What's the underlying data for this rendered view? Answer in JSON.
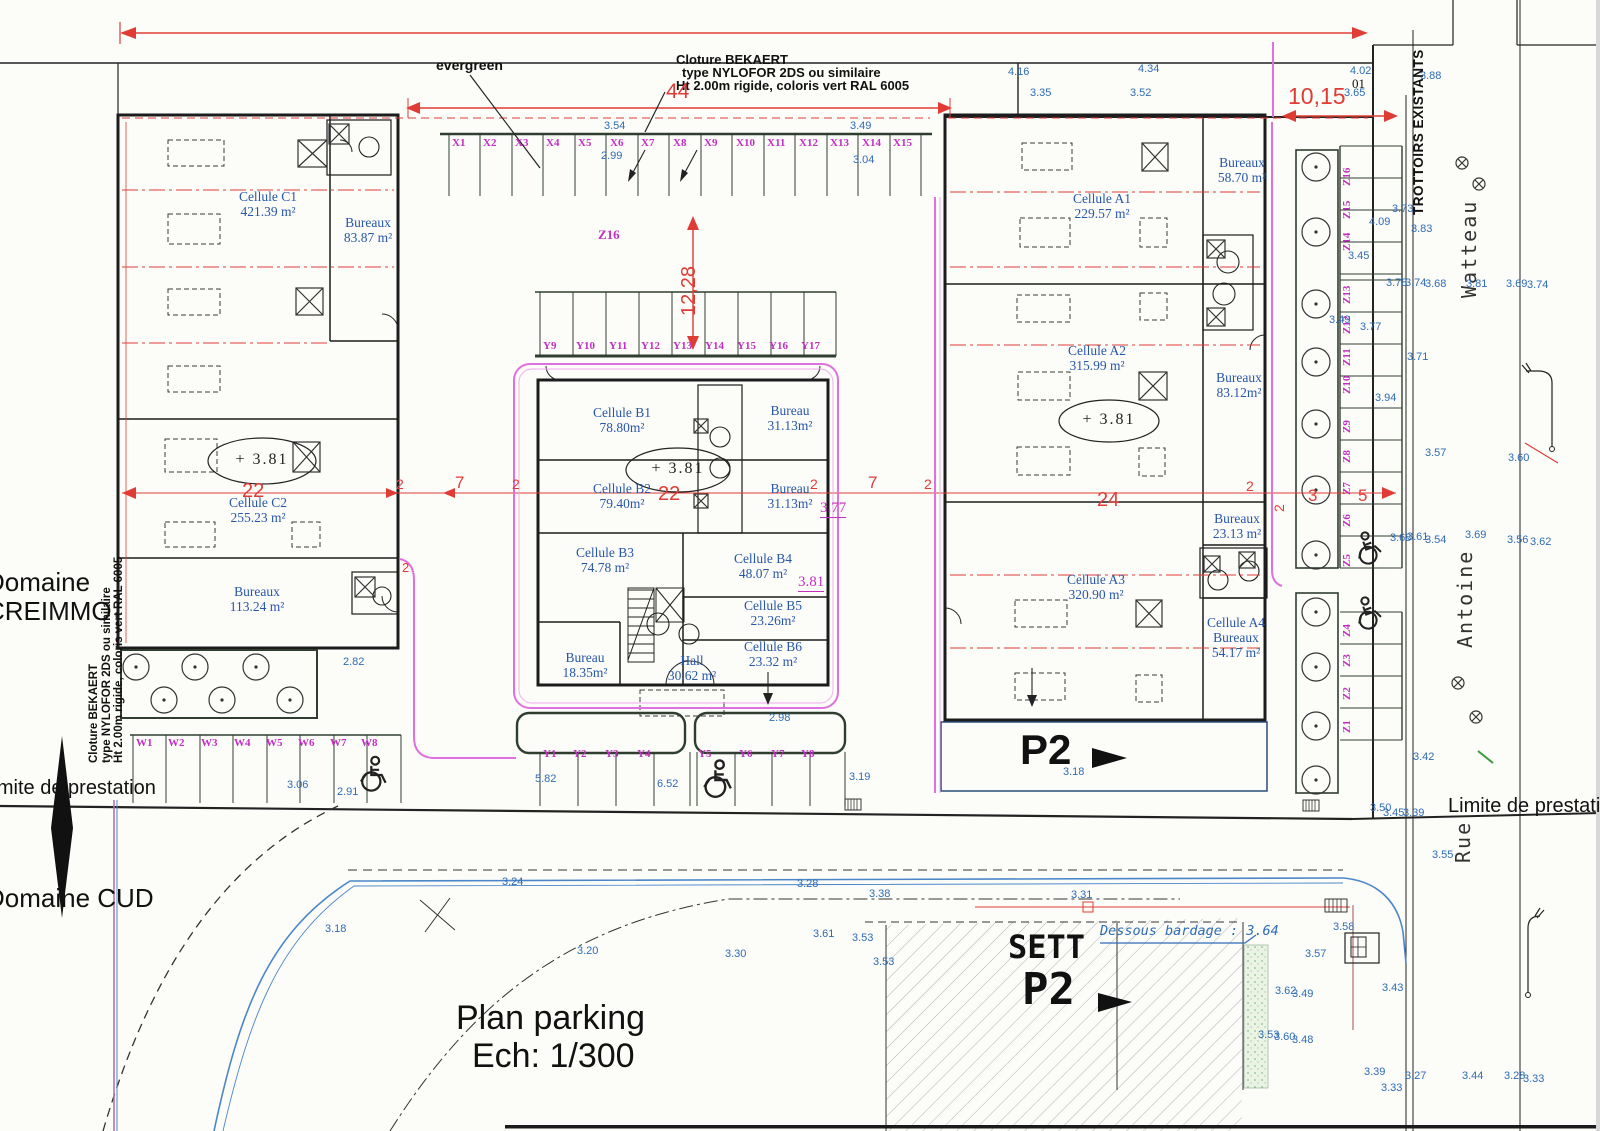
{
  "colors": {
    "blue_text": "#2e6cb5",
    "magenta_stall": "#c32fc3",
    "red_dim": "#e03c36",
    "pink_fence": "#e070e0",
    "wall": "#1c1c1c",
    "green_strip": "#8fbc8f"
  },
  "title": {
    "line1": "Plan parking",
    "line2": "Ech: 1/300"
  },
  "fence_note": {
    "l1": "Cloture BEKAERT",
    "l2": "type NYLOFOR 2DS ou similaire",
    "l3": "Ht 2.00m rigide, coloris vert RAL 6005"
  },
  "fence_note_left": {
    "l1": "Cloture BEKAERT",
    "l2": "type NYLOFOR 2DS ou similaire",
    "l3": "Ht 2.00m rigide, coloris vert RAL 6005"
  },
  "boundaries": {
    "domaine_creimmo": "Domaine CREIMMO",
    "domaine_cud": "Domaine CUD",
    "limite_left": "limite de prestation",
    "limite_right": "Limite de prestation",
    "trottoirs": "TROTTOIRS EXISTANTS"
  },
  "streets": {
    "watteau": "Watteau",
    "antoine": "Antoine",
    "rue": "Rue"
  },
  "misc": {
    "evergreen": "evergreen",
    "zone_z16": "Z16",
    "note_01": "01",
    "p2": "P2",
    "sett": "SETT",
    "sett_p2": "P2",
    "dessous_bardage": "Dessous bardage : 3.64"
  },
  "levels": {
    "plus_c": "+ 3.81",
    "plus_b": "+ 3.81",
    "plus_a": "+ 3.81",
    "floor_b": "3.81",
    "floor_b2": "3.77"
  },
  "dims": [
    "44",
    "12,28",
    "10,15",
    "22",
    "22",
    "24",
    "7",
    "7",
    "2",
    "2",
    "2",
    "2",
    "2",
    "2",
    "3",
    "5",
    "2"
  ],
  "rooms": [
    {
      "name": "Cellule C1",
      "area": "421.39 m²"
    },
    {
      "name": "Bureaux",
      "area": "83.87 m²"
    },
    {
      "name": "Cellule C2",
      "area": "255.23 m²"
    },
    {
      "name": "Bureaux",
      "area": "113.24 m²"
    },
    {
      "name": "Cellule B1",
      "area": "78.80m²"
    },
    {
      "name": "Bureau",
      "area": "31.13m²"
    },
    {
      "name": "Cellule B2",
      "area": "79.40m²"
    },
    {
      "name": "Bureau",
      "area": "31.13m²"
    },
    {
      "name": "Cellule B3",
      "area": "74.78 m²"
    },
    {
      "name": "Cellule B4",
      "area": "48.07 m²"
    },
    {
      "name": "Cellule B5",
      "area": "23.26m²"
    },
    {
      "name": "Cellule B6",
      "area": "23.32 m²"
    },
    {
      "name": "Bureau",
      "area": "18.35m²"
    },
    {
      "name": "Hall",
      "area": "30.62 m²"
    },
    {
      "name": "Cellule A1",
      "area": "229.57 m²"
    },
    {
      "name": "Bureaux",
      "area": "58.70 m²"
    },
    {
      "name": "Cellule A2",
      "area": "315.99 m²"
    },
    {
      "name": "Bureaux",
      "area": "83.12m²"
    },
    {
      "name": "Bureaux",
      "area": "23.13 m²"
    },
    {
      "name": "Cellule A3",
      "area": "320.90 m²"
    },
    {
      "name": "Cellule A4",
      "sub": "Bureaux",
      "area": "54.17 m²"
    }
  ],
  "spots": [
    "4.16",
    "3.35",
    "4.34",
    "3.52",
    "3.54",
    "2.99",
    "3.49",
    "3.04",
    "4.02",
    "3.65",
    "3.88",
    "3.73",
    "4.09",
    "3.83",
    "3.45",
    "3.78",
    "3.74",
    "3.68",
    "3.81",
    "3.69",
    "3.74",
    "3.49",
    "3.77",
    "3.71",
    "3.94",
    "3.57",
    "3.60",
    "3.68",
    "3.61",
    "3.54",
    "3.69",
    "3.56",
    "3.62",
    "3.42",
    "3.50",
    "3.45",
    "3.39",
    "3.55",
    "3.06",
    "2.91",
    "2.82",
    "5.82",
    "6.52",
    "2.98",
    "3.19",
    "3.18",
    "3.24",
    "3.28",
    "3.38",
    "3.31",
    "3.18",
    "3.20",
    "3.61",
    "3.53",
    "3.30",
    "3.53",
    "3.58",
    "3.57",
    "3.62",
    "3.49",
    "3.43",
    "3.53",
    "3.60",
    "3.48",
    "3.39",
    "3.33",
    "3.27",
    "3.44",
    "3.28",
    "3.33"
  ],
  "stalls": {
    "x": [
      "X1",
      "X2",
      "X3",
      "X4",
      "X5",
      "X6",
      "X7",
      "X8",
      "X9",
      "X10",
      "X11",
      "X12",
      "X13",
      "X14",
      "X15"
    ],
    "y": [
      "Y1",
      "Y2",
      "Y3",
      "Y4",
      "Y5",
      "Y6",
      "Y7",
      "Y8",
      "Y9",
      "Y10",
      "Y11",
      "Y12",
      "Y13",
      "Y14",
      "Y15",
      "Y16",
      "Y17"
    ],
    "w": [
      "W1",
      "W2",
      "W3",
      "W4",
      "W5",
      "W6",
      "W7",
      "W8"
    ],
    "z": [
      "Z1",
      "Z2",
      "Z3",
      "Z4",
      "Z5",
      "Z6",
      "Z7",
      "Z8",
      "Z9",
      "Z10",
      "Z11",
      "Z12",
      "Z13",
      "Z14",
      "Z15",
      "Z16"
    ]
  }
}
